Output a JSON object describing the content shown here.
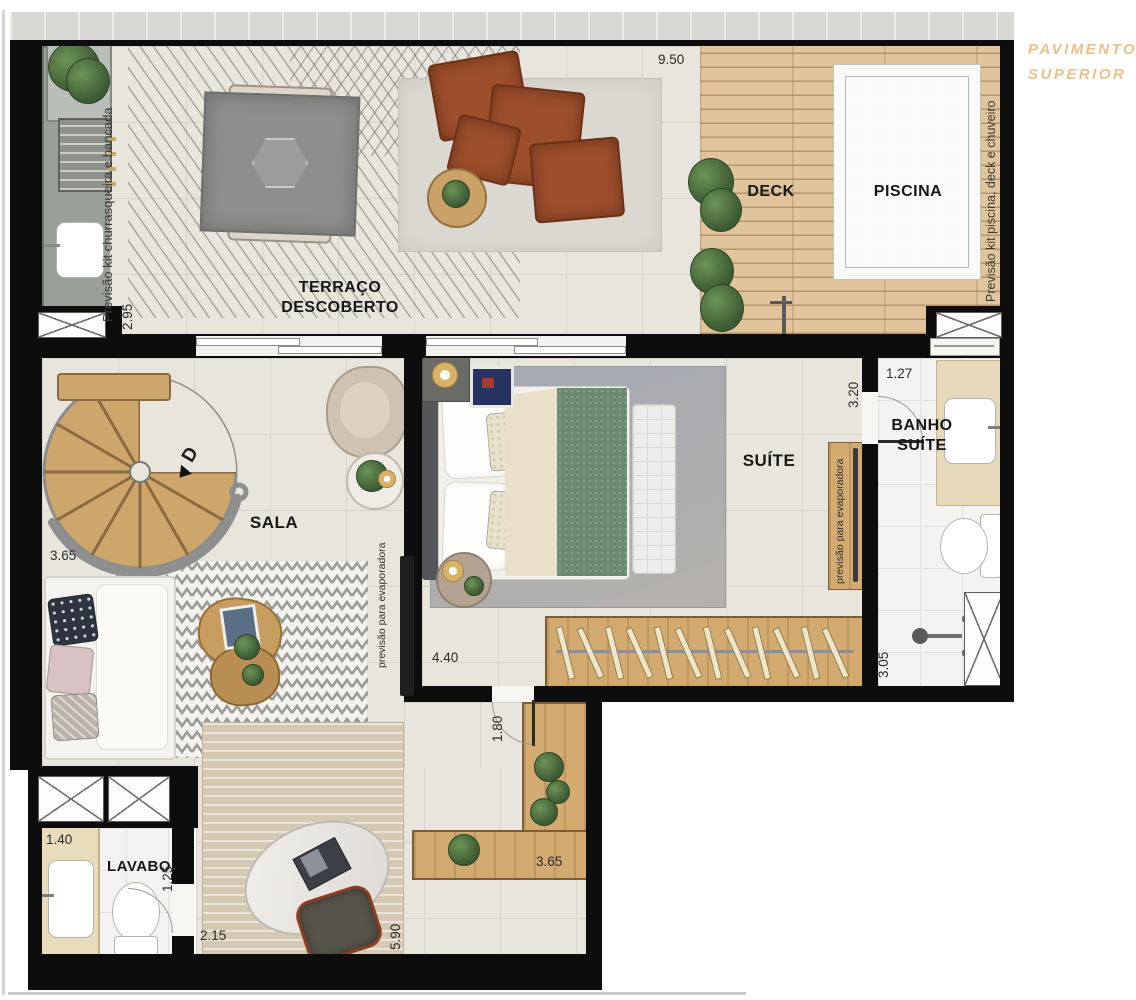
{
  "title": {
    "line1": "PAVIMENTO",
    "line2": "SUPERIOR"
  },
  "rooms": {
    "terraco": {
      "line1": "TERRAÇO",
      "line2": "DESCOBERTO"
    },
    "deck": "DECK",
    "piscina": "PISCINA",
    "sala": "SALA",
    "suite": "SUÍTE",
    "banho": {
      "line1": "BANHO",
      "line2": "SUÍTE"
    },
    "lavabo": "LAVABO"
  },
  "annotations": {
    "left_note": "Previsão kit churrasqueira e bancada",
    "right_note": "Previsão kit piscina, deck e chuveiro",
    "evap_sala": "previsão para evaporadora",
    "evap_suite": "previsão para evaporadora",
    "stair_direction": "D"
  },
  "dimensions": {
    "terrace_width": "9.50",
    "terrace_depth": "2.95",
    "sala_width": "3.65",
    "suite_depth": "3.20",
    "banho_width": "1.27",
    "suite_width": "4.40",
    "hall_depth": "1.80",
    "banho_depth": "3.05",
    "lavabo_width": "1.40",
    "lavabo_depth": "1.25",
    "hall_width": "2.15",
    "hall_height": "5.90",
    "bench_width": "3.65"
  },
  "closet": {
    "hanger_count": 12
  },
  "colors": {
    "wall": "#0d0d0d",
    "title_accent": "#ecc088",
    "pool_water": "#c6d7d5",
    "wood": "#d3ab71",
    "terracotta": "#9d4e2b"
  }
}
